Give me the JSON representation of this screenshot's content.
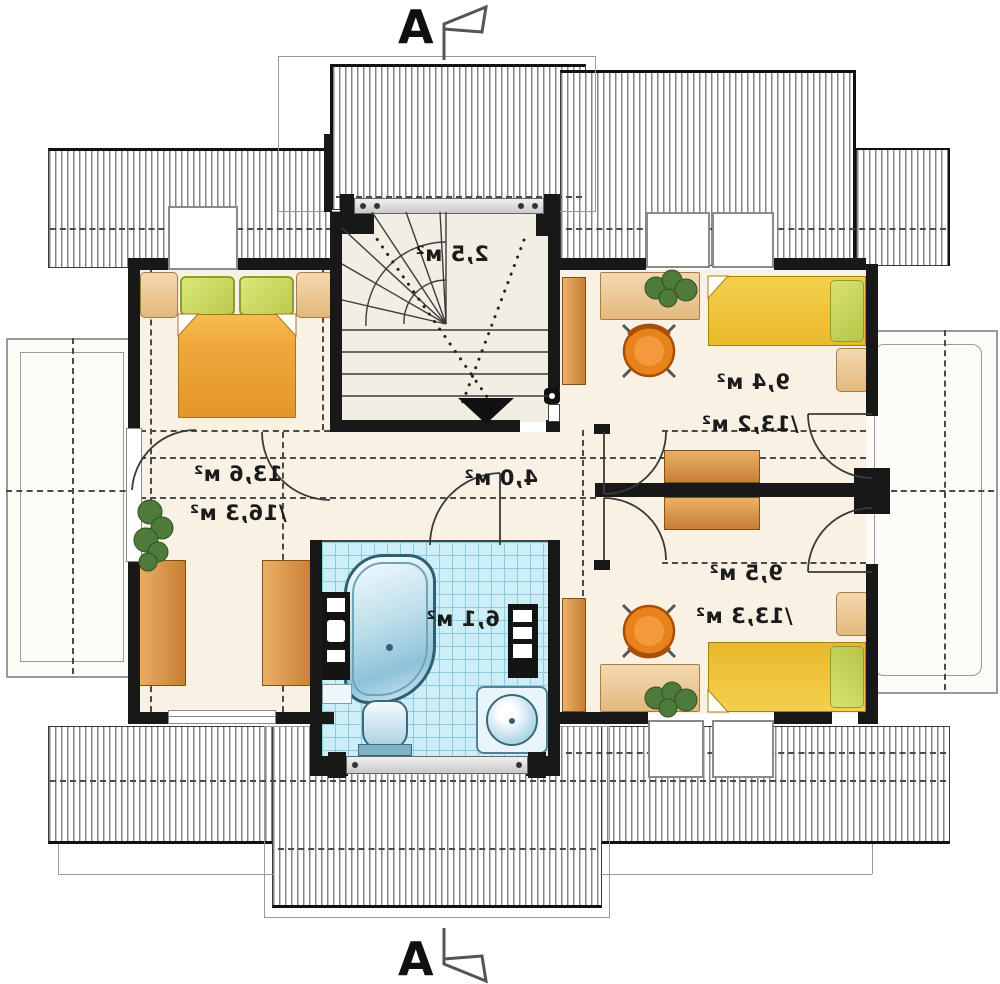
{
  "section_markers": {
    "top": "A",
    "bottom": "A"
  },
  "rooms": {
    "stairs": {
      "name": "staircase",
      "area": "2,5 м²"
    },
    "left_bedroom": {
      "name": "bedroom-left",
      "area": "13,6 м²",
      "area_total": "/16,3 м²"
    },
    "hall": {
      "name": "hall",
      "area": "4,0 м²"
    },
    "bathroom": {
      "name": "bathroom",
      "area": "6,1 м²"
    },
    "bedroom_top_right": {
      "name": "bedroom-right-1",
      "area": "9,4 м²",
      "area_total": "/13,2 м²"
    },
    "bedroom_bottom_right": {
      "name": "bedroom-right-2",
      "area": "9,5 м²",
      "area_total": "/13,3 м²"
    }
  },
  "colors": {
    "wall": "#181818",
    "floor_cream": "#f8f1e4",
    "hatch_line": "#858585",
    "bed_orange": "#f0a73a",
    "pillow_green": "#cddb66",
    "bed_yellow": "#efc83e",
    "furniture_tan": "#eed0a4",
    "wardrobe_orange": "#d89544",
    "chair_orange": "#e8831c",
    "tile_blue": "#cdeef6",
    "tile_line": "#8ecbdd",
    "fixture_blue": "#9fd0e6",
    "plant_green": "#4e7a3c"
  }
}
